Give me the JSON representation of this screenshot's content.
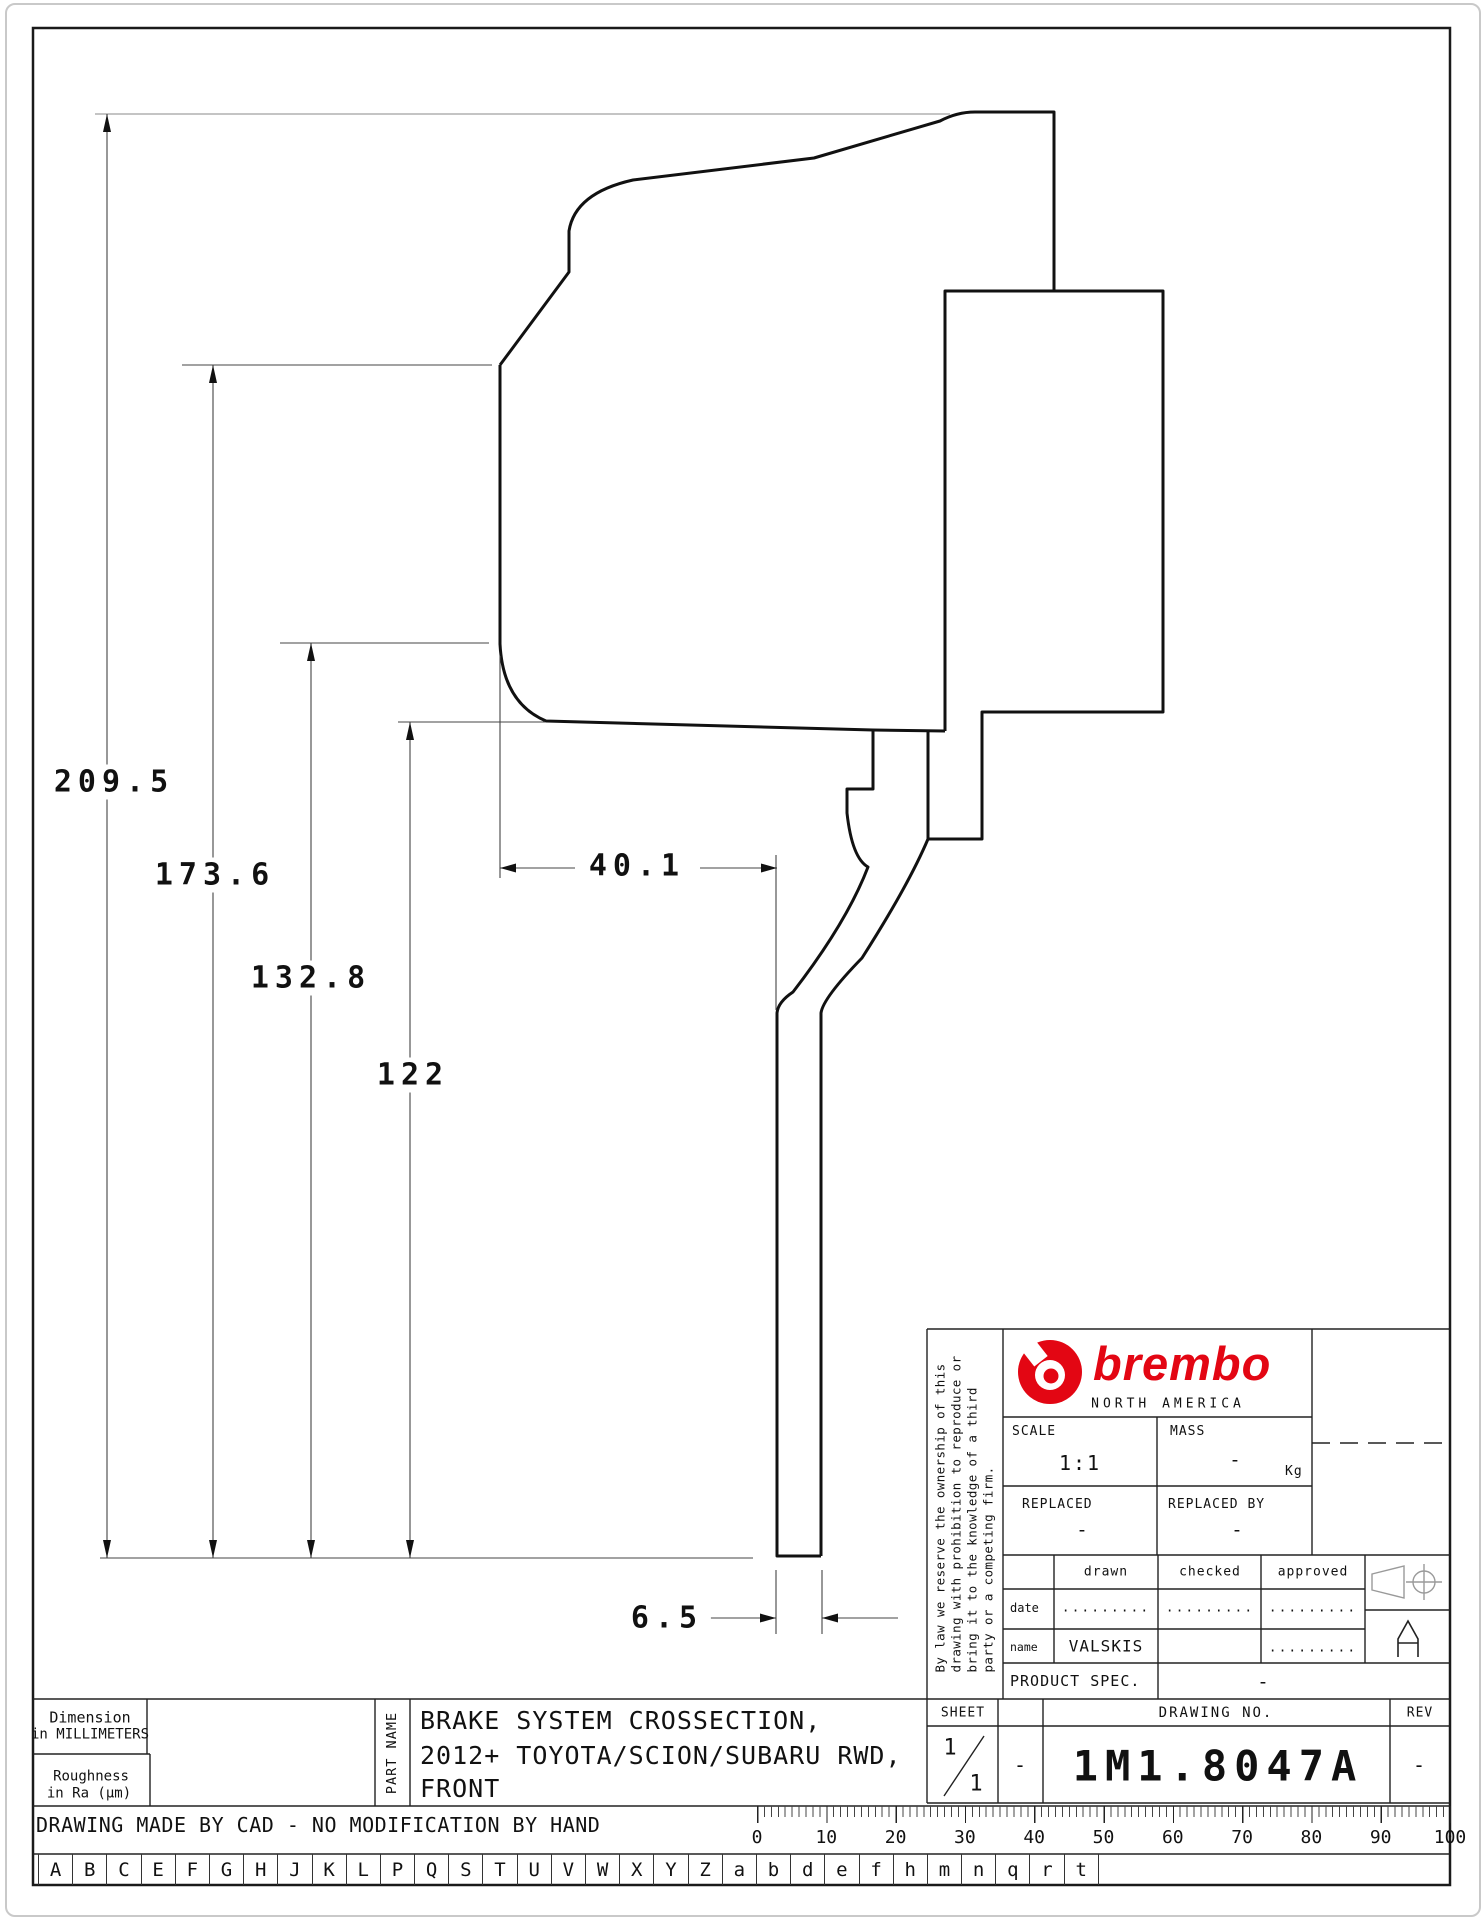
{
  "dimensions": {
    "overall_height": "209.5",
    "height_2": "173.6",
    "height_3": "132.8",
    "height_4": "122",
    "hat_depth": "40.1",
    "plate_thickness": "6.5"
  },
  "legal": {
    "lines": [
      "By law we reserve the ownership of this",
      "drawing with prohibition to reproduce or",
      "bring it to the knowledge of a third",
      "party or a competing firm."
    ]
  },
  "title_block": {
    "brand": {
      "name": "brembo",
      "region": "NORTH AMERICA"
    },
    "scale": {
      "label": "SCALE",
      "value": "1:1"
    },
    "mass": {
      "label": "MASS",
      "value": "-",
      "unit": "Kg"
    },
    "replaced": {
      "label": "REPLACED",
      "value": "-"
    },
    "replaced_by": {
      "label": "REPLACED BY",
      "value": "-"
    },
    "signoff": {
      "col_drawn": "drawn",
      "col_checked": "checked",
      "col_approved": "approved",
      "date_label": "date",
      "name_label": "name",
      "date_drawn": ".........",
      "date_checked": ".........",
      "date_approved": ".........",
      "name_drawn": "VALSKIS",
      "name_checked": "",
      "name_approved": "........."
    },
    "product_spec": {
      "label": "PRODUCT SPEC.",
      "value": "-"
    },
    "sheet": {
      "label": "SHEET",
      "current": "1",
      "total": "1",
      "dash": "-"
    },
    "drawing_no": {
      "label": "DRAWING NO.",
      "value": "1M1.8047A"
    },
    "rev": {
      "label": "REV",
      "value": "-"
    }
  },
  "part_info": {
    "dimension_note_1": "Dimension",
    "dimension_note_2": "in MILLIMETERS",
    "roughness_note_1": "Roughness",
    "roughness_note_2": "in Ra (µm)",
    "part_name_label": "PART NAME",
    "part_name_line_1": "BRAKE SYSTEM CROSSECTION,",
    "part_name_line_2": "2012+ TOYOTA/SCION/SUBARU RWD,",
    "part_name_line_3": "FRONT"
  },
  "footer": {
    "cad_note": "DRAWING MADE BY CAD - NO MODIFICATION BY HAND"
  },
  "ruler": {
    "labels": [
      "0",
      "10",
      "20",
      "30",
      "40",
      "50",
      "60",
      "70",
      "80",
      "90",
      "100"
    ]
  },
  "bottom_letters": [
    "A",
    "B",
    "C",
    "E",
    "F",
    "G",
    "H",
    "J",
    "K",
    "L",
    "P",
    "Q",
    "S",
    "T",
    "U",
    "V",
    "W",
    "X",
    "Y",
    "Z",
    "a",
    "b",
    "d",
    "e",
    "f",
    "h",
    "m",
    "n",
    "q",
    "r",
    "t"
  ],
  "colors": {
    "brand_red": "#e30613",
    "line_black": "#1a1a1a"
  }
}
